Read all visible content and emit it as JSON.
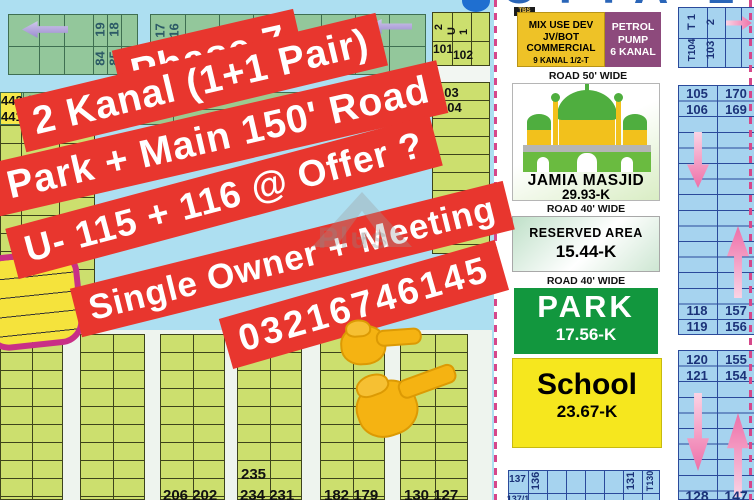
{
  "colors": {
    "banner_red": "#e8362e",
    "park_green": "#12973e",
    "school_yellow": "#f6e71e",
    "petrol_purple": "#8d4a7c",
    "mix_yellow": "#eec227",
    "dash_pink": "#d6478a"
  },
  "banner": {
    "line1": "Phase 7",
    "line2": "2 Kanal (1+1 Pair)",
    "line3": "Park + Main 150' Road",
    "line4": "U- 115 + 116 @ Offer ?",
    "line5": "Single Owner + Meeting",
    "line6": "03216746145"
  },
  "watermark": {
    "text": "Plus",
    "plus": "+"
  },
  "left_map": {
    "block_a": {
      "n19": "19",
      "n18": "18",
      "n84": "84",
      "n85": "85",
      "n17": "17",
      "n16": "16"
    },
    "block_b": {
      "n442": "442",
      "n441": "441",
      "n377": "377",
      "n378": "378",
      "n376": "376",
      "n375": "375"
    },
    "block_c": {
      "r2": "2",
      "ru1": "U 1",
      "n101": "101",
      "n102": "102",
      "n103": "103",
      "n104": "104"
    },
    "bottom": {
      "g1": "206 202",
      "g2a": "235",
      "g2b": "234 231",
      "g3": "182 179",
      "g4": "130 127"
    }
  },
  "right_panel": {
    "header_fragment": "UTTA 2 0",
    "tbs_label": "TBS",
    "mix_use": {
      "l1": "MIX USE DEV",
      "l2": "JV/BOT",
      "l3": "COMMERCIAL",
      "l4": "9 KANAL 1/2-T"
    },
    "petrol": {
      "l1": "PETROL",
      "l2": "PUMP",
      "l3": "6 KANAL"
    },
    "road_50": "ROAD 50' WIDE",
    "masjid": {
      "name": "JAMIA MASJID",
      "area": "29.93-K"
    },
    "road_40_a": "ROAD 40' WIDE",
    "reserved": {
      "name": "RESERVED AREA",
      "area": "15.44-K"
    },
    "road_40_b": "ROAD 40' WIDE",
    "park": {
      "name": "PARK",
      "area": "17.56-K"
    },
    "school": {
      "name": "School",
      "area": "23.67-K"
    },
    "bottom_grid": {
      "c137": "137",
      "c136": "136",
      "c131": "131",
      "c130": "T130",
      "c137_1": "137/1"
    },
    "top_grid": {
      "t1": "T 1",
      "t104": "T104",
      "n2": "2",
      "n103": "103"
    },
    "col1": {
      "a1": "105",
      "a2": "170",
      "b1": "106",
      "b2": "169",
      "c1": "118",
      "c2": "157",
      "d1": "119",
      "d2": "156"
    },
    "col2": {
      "a1": "120",
      "a2": "155",
      "b1": "121",
      "b2": "154",
      "c1": "128",
      "c2": "147"
    }
  }
}
